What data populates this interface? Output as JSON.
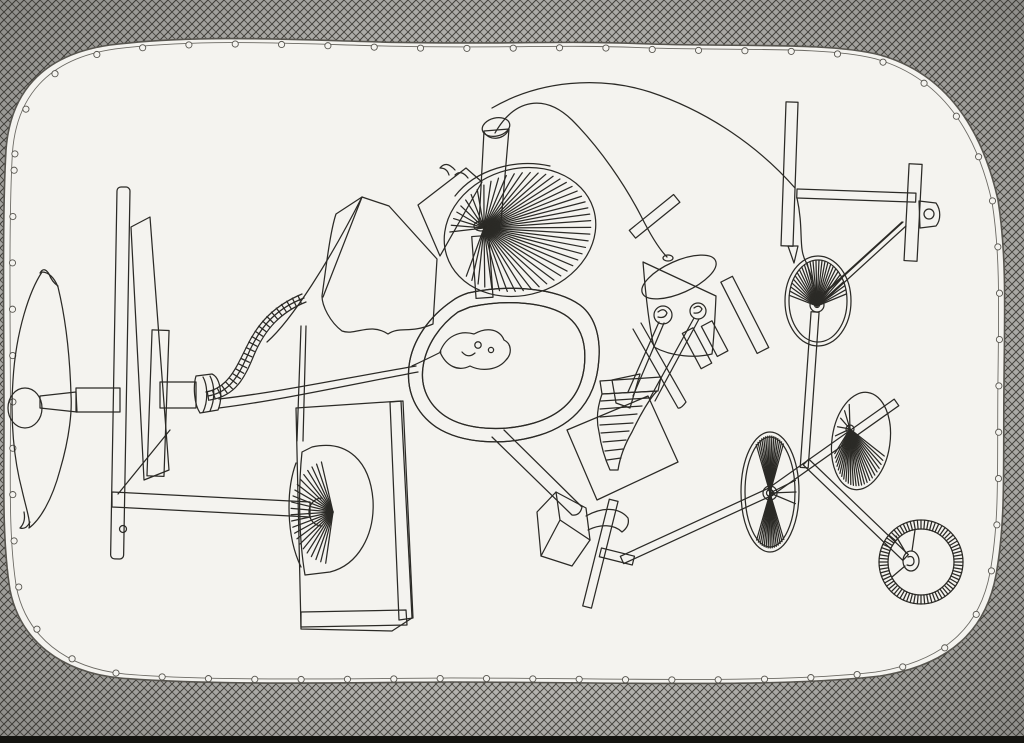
{
  "artwork": {
    "title": "Untitled pen-and-ink drawing of a whimsical machine contraption",
    "medium": "pen and ink on paper, crosshatched mat border with stitched oval boundary",
    "text_visible": "none",
    "palette": {
      "paper": "#f4f3ef",
      "mat_gray": "#b4b3af",
      "ink": "#2b2a26",
      "ink_soft": "#57554f",
      "bottom_band": "#141410"
    },
    "components": [
      "crosshatched-mat-border",
      "stitched-rounded-boundary",
      "leaf-vane",
      "hatched-mast-planks",
      "drive-beam",
      "nozzle-and-cable",
      "hatched-strap",
      "sail-kite",
      "strut-arm",
      "chimney-cylinder",
      "radial-spoke-fan",
      "hatched-stalk",
      "kidney-drum",
      "hand-blob",
      "paddle-arm",
      "striped-cabinet",
      "pleated-half-fan",
      "wavy-panel",
      "auger-funnel",
      "canister-figure",
      "eye-screws",
      "scraper-blade",
      "coil-springs",
      "striped-mini-bar",
      "wire-arcs",
      "gantry-frame",
      "pulley-wheel-upper",
      "pulley-wheel-left",
      "pulley-wheel-top",
      "ladder-rods",
      "ring-wheel",
      "hook-box",
      "barber-pole-rod"
    ]
  },
  "figures": {
    "stitches": {
      "spacing": 47,
      "r": 3.1,
      "dx": 9,
      "dy": 6,
      "scale": 0.986
    },
    "wheels": [
      {
        "id": "fan-spokes",
        "cx": 520,
        "cy": 232,
        "rx": 72,
        "ry": 58,
        "rot": -18,
        "hub": [
          484,
          228
        ],
        "ranges": [
          [
            -158,
            158,
            6.5
          ]
        ],
        "w": 0.85
      },
      {
        "id": "left-wheel-spokes",
        "cx": 770,
        "cy": 492,
        "rx": 26,
        "ry": 56,
        "rot": 0,
        "hub": [
          770,
          493
        ],
        "ranges": [
          [
            -122,
            -58,
            4.5
          ],
          [
            58,
            122,
            4.5
          ],
          [
            -12,
            12,
            12
          ]
        ],
        "w": 0.8
      },
      {
        "id": "top-wheel-spokes",
        "cx": 861,
        "cy": 441,
        "rx": 26,
        "ry": 45,
        "rot": 8,
        "hub": [
          850,
          429
        ],
        "ranges": [
          [
            15,
            160,
            6
          ],
          [
            -178,
            -120,
            12
          ]
        ],
        "w": 0.8
      },
      {
        "id": "right-wheel-spokes",
        "cx": 818,
        "cy": 301,
        "rx": 29,
        "ry": 41,
        "rot": 0,
        "hub": [
          817,
          306
        ],
        "ranges": [
          [
            -172,
            -8,
            6
          ]
        ],
        "w": 0.8
      },
      {
        "id": "block-fan-spokes",
        "cx": 333,
        "cy": 512,
        "rx": 42,
        "ry": 52,
        "rot": 0,
        "hub": [
          333,
          512
        ],
        "ranges": [
          [
            100,
            258,
            7
          ]
        ],
        "w": 0.9
      }
    ],
    "ring_ticks": {
      "id": "ring-ticks",
      "cx": 921,
      "cy": 562,
      "r1": 33,
      "r2": 42,
      "step": 5
    },
    "hatch_bands": [
      {
        "path": "strap-core",
        "spacing": 6,
        "len": 9,
        "w": 0.8
      }
    ]
  }
}
